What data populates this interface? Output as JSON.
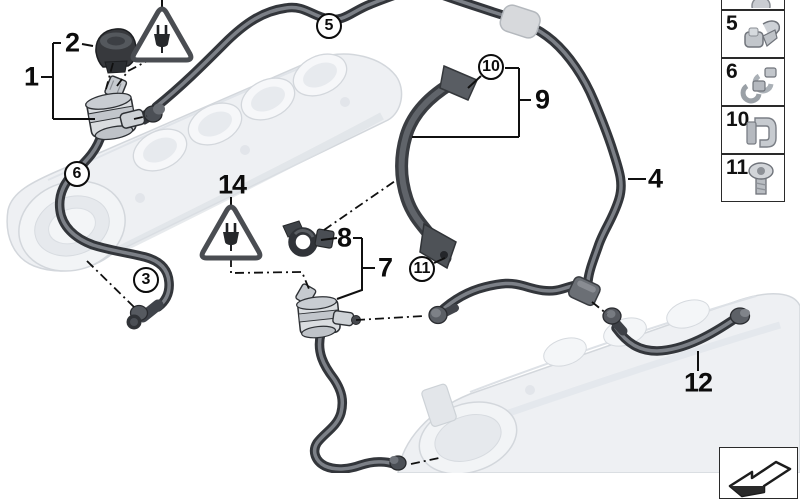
{
  "diagram": {
    "kind": "exploded-parts-diagram",
    "subject": "Fuel tank ventilation valves and vent hoses on ghosted intake manifolds",
    "background": "#ffffff",
    "callouts": {
      "c1": {
        "label": "1",
        "style": "plain"
      },
      "c2": {
        "label": "2",
        "style": "plain"
      },
      "c3": {
        "label": "3",
        "style": "circled"
      },
      "c4": {
        "label": "4",
        "style": "plain"
      },
      "c5": {
        "label": "5",
        "style": "circled"
      },
      "c6": {
        "label": "6",
        "style": "circled"
      },
      "c7": {
        "label": "7",
        "style": "plain"
      },
      "c8": {
        "label": "8",
        "style": "plain"
      },
      "c9": {
        "label": "9",
        "style": "plain"
      },
      "c10": {
        "label": "10",
        "style": "circled"
      },
      "c11": {
        "label": "11",
        "style": "circled"
      },
      "c12": {
        "label": "12",
        "style": "plain"
      },
      "c14": {
        "label": "14",
        "style": "plain"
      }
    },
    "icons": {
      "warning": "electric-plug-warning-triangle",
      "continuation": "page-continues-arrow"
    },
    "colors": {
      "hose": "#33363b",
      "ghost_part": "#eef0f3",
      "line": "#101010"
    }
  },
  "sidebar": {
    "items": [
      {
        "label": "",
        "icon": "partial-part-icon"
      },
      {
        "label": "5",
        "icon": "hose-clip-icon"
      },
      {
        "label": "6",
        "icon": "double-clip-icon"
      },
      {
        "label": "10",
        "icon": "sheet-metal-clip-icon"
      },
      {
        "label": "11",
        "icon": "screw-icon"
      }
    ]
  },
  "footer": {
    "corner_icon": "page-continues-arrow"
  }
}
